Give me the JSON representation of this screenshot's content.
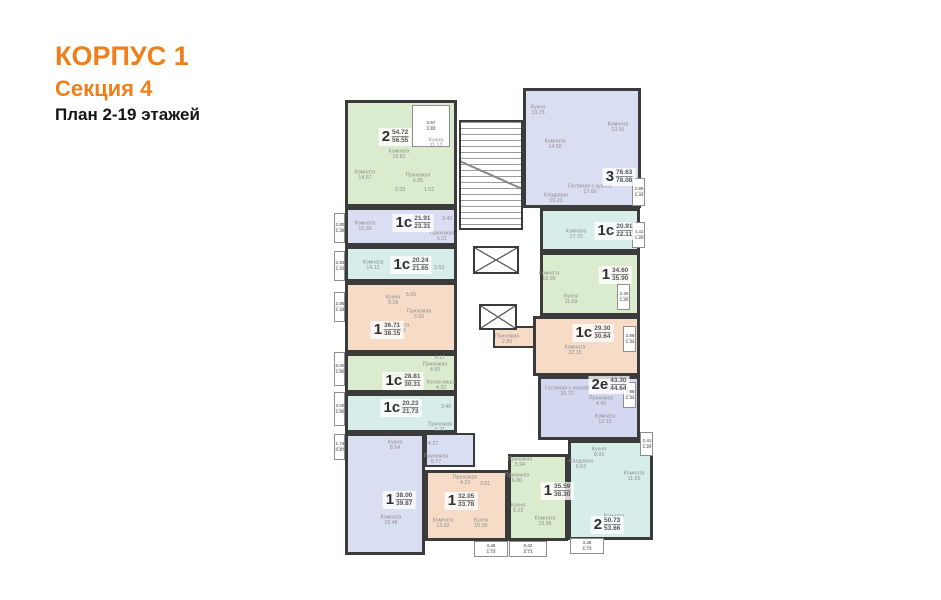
{
  "header": {
    "line1": "КОРПУС 1",
    "line2": "Секция 4",
    "line3": "План 2-19 этажей",
    "accent_color": "#ef7f1b"
  },
  "plan": {
    "wall_color": "#3b3b3b",
    "colors": {
      "green": "#daeccd",
      "teal": "#d6edea",
      "lavender": "#dadef2",
      "lavender2": "#d3d8f0",
      "peach": "#f6dcc6"
    },
    "apartments": [
      {
        "id": "2-5472",
        "type": "2",
        "area_base": "54.72",
        "area_total": "56.55",
        "color": "#daeccd",
        "box": {
          "x": 12,
          "y": 14,
          "w": 112,
          "h": 107
        },
        "label": {
          "x": 62,
          "y": 51
        },
        "rooms": [
          {
            "name": "Комната",
            "area": "15.81",
            "x": 66,
            "y": 68
          },
          {
            "name": "Кухня",
            "area": "11.17",
            "x": 103,
            "y": 57
          },
          {
            "name": "Комната",
            "area": "14.57",
            "x": 32,
            "y": 89
          },
          {
            "name": "Прихожая",
            "area": "6.85",
            "x": 85,
            "y": 92
          },
          {
            "name": "",
            "area": "3.33",
            "x": 67,
            "y": 104
          },
          {
            "name": "",
            "area": "1.52",
            "x": 96,
            "y": 104
          }
        ]
      },
      {
        "id": "3-7663",
        "type": "3",
        "area_base": "76.63",
        "area_total": "78.08",
        "color": "#dadef2",
        "box": {
          "x": 190,
          "y": 2,
          "w": 118,
          "h": 120
        },
        "label": {
          "x": 286,
          "y": 91
        },
        "rooms": [
          {
            "name": "Кухня",
            "area": "13.75",
            "x": 205,
            "y": 24
          },
          {
            "name": "Комната",
            "area": "14.50",
            "x": 222,
            "y": 58
          },
          {
            "name": "Комната",
            "area": "13.91",
            "x": 285,
            "y": 41
          },
          {
            "name": "Гостиная с кухней",
            "area": "17.60",
            "x": 257,
            "y": 103
          },
          {
            "name": "Кладовая",
            "area": "10.23",
            "x": 223,
            "y": 112
          }
        ]
      },
      {
        "id": "1c-2191",
        "type": "1с",
        "area_base": "21.91",
        "area_total": "23.31",
        "color": "#dadef2",
        "box": {
          "x": 12,
          "y": 121,
          "w": 112,
          "h": 39
        },
        "label": {
          "x": 80,
          "y": 137
        },
        "rooms": [
          {
            "name": "Комната",
            "area": "15.30",
            "x": 32,
            "y": 140
          },
          {
            "name": "Прихожая",
            "area": "5.21",
            "x": 109,
            "y": 150
          },
          {
            "name": "",
            "area": "3.40",
            "x": 114,
            "y": 133
          }
        ]
      },
      {
        "id": "1c-2024",
        "type": "1с",
        "area_base": "20.24",
        "area_total": "21.65",
        "color": "#d6edea",
        "box": {
          "x": 12,
          "y": 160,
          "w": 112,
          "h": 36
        },
        "label": {
          "x": 78,
          "y": 179
        },
        "rooms": [
          {
            "name": "Комната",
            "area": "14.12",
            "x": 40,
            "y": 179
          },
          {
            "name": "",
            "area": "3.53",
            "x": 106,
            "y": 182
          }
        ]
      },
      {
        "id": "1c-2091",
        "type": "1с",
        "area_base": "20.91",
        "area_total": "22.11",
        "color": "#d6edea",
        "box": {
          "x": 207,
          "y": 122,
          "w": 100,
          "h": 44
        },
        "label": {
          "x": 282,
          "y": 145
        },
        "rooms": [
          {
            "name": "Комната",
            "area": "17.70",
            "x": 243,
            "y": 148
          }
        ]
      },
      {
        "id": "1-3460",
        "type": "1",
        "area_base": "34.60",
        "area_total": "35.90",
        "color": "#daeccd",
        "box": {
          "x": 207,
          "y": 166,
          "w": 100,
          "h": 64
        },
        "label": {
          "x": 282,
          "y": 189
        },
        "rooms": [
          {
            "name": "Комната",
            "area": "15.95",
            "x": 216,
            "y": 190
          },
          {
            "name": "Кухня",
            "area": "11.69",
            "x": 238,
            "y": 213
          }
        ]
      },
      {
        "id": "1-3671",
        "type": "1",
        "area_base": "36.71",
        "area_total": "38.15",
        "color": "#f6dcc6",
        "box": {
          "x": 12,
          "y": 196,
          "w": 112,
          "h": 71
        },
        "label": {
          "x": 54,
          "y": 244
        },
        "rooms": [
          {
            "name": "Кухня",
            "area": "9.28",
            "x": 60,
            "y": 214
          },
          {
            "name": "",
            "area": "5.65",
            "x": 78,
            "y": 209
          },
          {
            "name": "Прихожая",
            "area": "5.65",
            "x": 86,
            "y": 228
          },
          {
            "name": "Комната",
            "area": "16.88",
            "x": 66,
            "y": 242
          }
        ]
      },
      {
        "id": "1c-2930",
        "type": "1с",
        "area_base": "29.30",
        "area_total": "30.64",
        "color": "#f6dcc6",
        "box": {
          "x": 200,
          "y": 230,
          "w": 107,
          "h": 60
        },
        "label": {
          "x": 260,
          "y": 247
        },
        "rooms": [
          {
            "name": "Комната",
            "area": "22.15",
            "x": 242,
            "y": 264
          },
          {
            "name": "Прихожая",
            "area": "2.80",
            "x": 174,
            "y": 253
          }
        ]
      },
      {
        "id": "1c-2881",
        "type": "1с",
        "area_base": "28.81",
        "area_total": "30.31",
        "color": "#daeccd",
        "box": {
          "x": 12,
          "y": 267,
          "w": 112,
          "h": 40
        },
        "label": {
          "x": 70,
          "y": 295
        },
        "rooms": [
          {
            "name": "",
            "area": "4.17",
            "x": 107,
            "y": 272
          },
          {
            "name": "Прихожая",
            "area": "4.50",
            "x": 102,
            "y": 281
          },
          {
            "name": "Комната",
            "area": "16.02",
            "x": 62,
            "y": 292
          },
          {
            "name": "Кухня-ниша",
            "area": "4.32",
            "x": 108,
            "y": 299
          }
        ]
      },
      {
        "id": "2e-4330",
        "type": "2е",
        "area_base": "43.30",
        "area_total": "44.64",
        "color": "#d3d8f0",
        "box": {
          "x": 205,
          "y": 290,
          "w": 102,
          "h": 64
        },
        "label": {
          "x": 276,
          "y": 299
        },
        "rooms": [
          {
            "name": "Гостиная с кухней",
            "area": "20.72",
            "x": 234,
            "y": 305
          },
          {
            "name": "Прихожая",
            "area": "4.45",
            "x": 268,
            "y": 315
          },
          {
            "name": "Комната",
            "area": "12.15",
            "x": 272,
            "y": 333
          }
        ]
      },
      {
        "id": "1c-2023",
        "type": "1с",
        "area_base": "20.23",
        "area_total": "21.73",
        "color": "#d6edea",
        "box": {
          "x": 12,
          "y": 307,
          "w": 112,
          "h": 40
        },
        "label": {
          "x": 68,
          "y": 322
        },
        "rooms": [
          {
            "name": "Комната",
            "area": "15.62",
            "x": 78,
            "y": 325
          },
          {
            "name": "",
            "area": "3.40",
            "x": 113,
            "y": 321
          },
          {
            "name": "Прихожая",
            "area": "5.21",
            "x": 107,
            "y": 341
          }
        ]
      },
      {
        "id": "2-5073",
        "type": "2",
        "area_base": "50.73",
        "area_total": "53.66",
        "color": "#d6edea",
        "box": {
          "x": 235,
          "y": 354,
          "w": 85,
          "h": 100
        },
        "label": {
          "x": 274,
          "y": 439
        },
        "rooms": [
          {
            "name": "Кухня",
            "area": "8.93",
            "x": 266,
            "y": 366
          },
          {
            "name": "Комната",
            "area": "11.55",
            "x": 301,
            "y": 390
          },
          {
            "name": "Комната",
            "area": "15.68",
            "x": 281,
            "y": 433
          },
          {
            "name": "Кладовая",
            "area": "6.63",
            "x": 248,
            "y": 378
          }
        ]
      },
      {
        "id": "1-3800",
        "type": "1",
        "area_base": "38.00",
        "area_total": "39.87",
        "color": "#dadef2",
        "box": {
          "x": 12,
          "y": 347,
          "w": 80,
          "h": 122
        },
        "label": {
          "x": 66,
          "y": 414
        },
        "rooms": [
          {
            "name": "Кухня",
            "area": "8.54",
            "x": 62,
            "y": 359
          },
          {
            "name": "",
            "area": "4.27",
            "x": 100,
            "y": 358
          },
          {
            "name": "Прихожая",
            "area": "5.77",
            "x": 103,
            "y": 373
          },
          {
            "name": "Комната",
            "area": "15.48",
            "x": 58,
            "y": 434
          }
        ]
      },
      {
        "id": "1-3205",
        "type": "1",
        "area_base": "32.05",
        "area_total": "33.78",
        "color": "#f6dcc6",
        "box": {
          "x": 92,
          "y": 384,
          "w": 83,
          "h": 71
        },
        "label": {
          "x": 128,
          "y": 415
        },
        "rooms": [
          {
            "name": "Прихожая",
            "area": "4.22",
            "x": 132,
            "y": 394
          },
          {
            "name": "",
            "area": "3.81",
            "x": 152,
            "y": 398
          },
          {
            "name": "Комната",
            "area": "13.82",
            "x": 110,
            "y": 437
          },
          {
            "name": "Кухня",
            "area": "10.06",
            "x": 148,
            "y": 437
          }
        ]
      },
      {
        "id": "1-3559",
        "type": "1",
        "area_base": "35.59",
        "area_total": "38.30",
        "color": "#daeccd",
        "box": {
          "x": 175,
          "y": 368,
          "w": 60,
          "h": 87
        },
        "label": {
          "x": 224,
          "y": 405
        },
        "rooms": [
          {
            "name": "Прихожая",
            "area": "5.94",
            "x": 187,
            "y": 376
          },
          {
            "name": "Прихожая",
            "area": "6.80",
            "x": 184,
            "y": 392
          },
          {
            "name": "Кухня",
            "area": "9.23",
            "x": 185,
            "y": 422
          },
          {
            "name": "Комната",
            "area": "15.95",
            "x": 212,
            "y": 435
          }
        ]
      }
    ],
    "patches": [
      {
        "x": 92,
        "y": 347,
        "w": 50,
        "h": 34,
        "color": "#dadef2"
      },
      {
        "x": 160,
        "y": 240,
        "w": 42,
        "h": 22,
        "color": "#f6dcc6"
      }
    ],
    "balconies": [
      {
        "a": "3.67",
        "b": "1.83",
        "x": 79,
        "y": 19,
        "w": 38,
        "h": 42
      },
      {
        "a": "2.80",
        "b": "1.40",
        "x": 1,
        "y": 127,
        "w": 11,
        "h": 30
      },
      {
        "a": "2.83",
        "b": "1.41",
        "x": 1,
        "y": 165,
        "w": 11,
        "h": 30
      },
      {
        "a": "2.89",
        "b": "1.44",
        "x": 1,
        "y": 206,
        "w": 11,
        "h": 30
      },
      {
        "a": "5.00",
        "b": "1.50",
        "x": 1,
        "y": 266,
        "w": 11,
        "h": 34
      },
      {
        "a": "3.00",
        "b": "1.50",
        "x": 1,
        "y": 306,
        "w": 11,
        "h": 34
      },
      {
        "a": "1.74",
        "b": "0.87",
        "x": 1,
        "y": 348,
        "w": 11,
        "h": 26
      },
      {
        "a": "2.85",
        "b": "1.43",
        "x": 299,
        "y": 92,
        "w": 13,
        "h": 28
      },
      {
        "a": "2.41",
        "b": "1.20",
        "x": 299,
        "y": 136,
        "w": 13,
        "h": 26
      },
      {
        "a": "2.40",
        "b": "1.20",
        "x": 284,
        "y": 198,
        "w": 13,
        "h": 26
      },
      {
        "a": "2.88",
        "b": "1.34",
        "x": 290,
        "y": 240,
        "w": 13,
        "h": 26
      },
      {
        "a": "2.88",
        "b": "1.34",
        "x": 290,
        "y": 296,
        "w": 13,
        "h": 26
      },
      {
        "a": "2.41",
        "b": "1.20",
        "x": 307,
        "y": 346,
        "w": 13,
        "h": 24
      },
      {
        "a": "3.46",
        "b": "1.73",
        "x": 141,
        "y": 455,
        "w": 34,
        "h": 16
      },
      {
        "a": "5.42",
        "b": "2.71",
        "x": 176,
        "y": 455,
        "w": 38,
        "h": 16
      },
      {
        "a": "3.46",
        "b": "1.73",
        "x": 237,
        "y": 452,
        "w": 34,
        "h": 16
      }
    ]
  }
}
